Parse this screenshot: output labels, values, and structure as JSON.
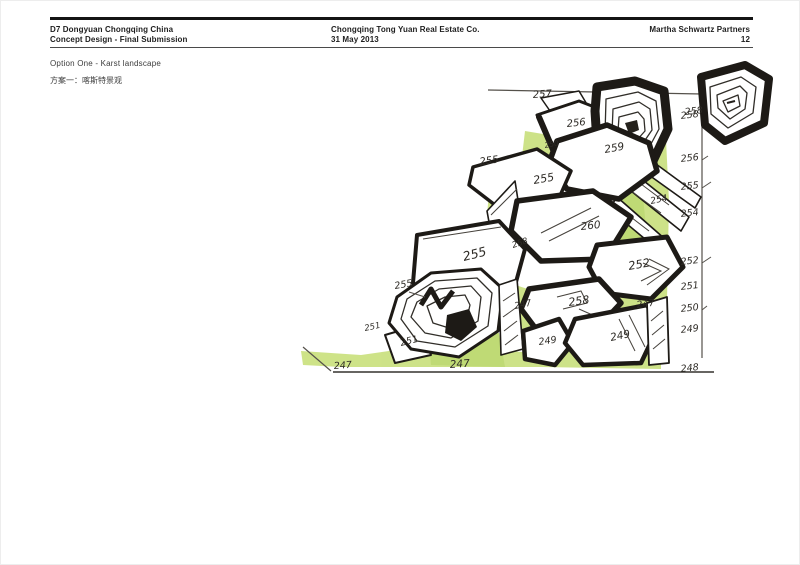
{
  "header": {
    "project_line1": "D7 Dongyuan Chongqing China",
    "project_line2": "Concept Design - Final Submission",
    "client_line1": "Chongqing Tong Yuan Real Estate Co.",
    "client_line2": "31 May 2013",
    "firm": "Martha Schwartz Partners",
    "page_number": "12"
  },
  "title": {
    "en": "Option One - Karst landscape",
    "cn": "方案一：喀斯特景观"
  },
  "sketch": {
    "colors": {
      "ink": "#1d1a16",
      "green": "#cbe182",
      "green_dark": "#bcd96e",
      "pencil": "#55514b"
    },
    "plan_labels": [
      {
        "text": "257",
        "x": 532,
        "y": 97,
        "rot": -4,
        "size": 10
      },
      {
        "text": "256",
        "x": 566,
        "y": 126,
        "rot": -6,
        "size": 10
      },
      {
        "text": "250",
        "x": 544,
        "y": 147,
        "rot": -10,
        "size": 7.5
      },
      {
        "text": "255",
        "x": 479,
        "y": 164,
        "rot": -8,
        "size": 10
      },
      {
        "text": "258",
        "x": 684,
        "y": 114,
        "rot": -6,
        "size": 9.5
      },
      {
        "text": "259",
        "x": 604,
        "y": 152,
        "rot": -10,
        "size": 10.5
      },
      {
        "text": "255",
        "x": 533,
        "y": 183,
        "rot": -10,
        "size": 11
      },
      {
        "text": "254",
        "x": 650,
        "y": 203,
        "rot": -12,
        "size": 9
      },
      {
        "text": "260",
        "x": 580,
        "y": 229,
        "rot": -6,
        "size": 10.5
      },
      {
        "text": "255",
        "x": 463,
        "y": 260,
        "rot": -14,
        "size": 12.5
      },
      {
        "text": "258",
        "x": 512,
        "y": 247,
        "rot": -18,
        "size": 8.5
      },
      {
        "text": "252",
        "x": 628,
        "y": 269,
        "rot": -10,
        "size": 11.5
      },
      {
        "text": "255",
        "x": 394,
        "y": 288,
        "rot": -10,
        "size": 9.5
      },
      {
        "text": "247",
        "x": 514,
        "y": 308,
        "rot": -12,
        "size": 9
      },
      {
        "text": "258",
        "x": 568,
        "y": 305,
        "rot": -8,
        "size": 11
      },
      {
        "text": "247",
        "x": 636,
        "y": 307,
        "rot": -8,
        "size": 9.5
      },
      {
        "text": "251",
        "x": 364,
        "y": 330,
        "rot": -12,
        "size": 8.5
      },
      {
        "text": "251",
        "x": 400,
        "y": 345,
        "rot": -14,
        "size": 9.5
      },
      {
        "text": "249",
        "x": 538,
        "y": 344,
        "rot": -8,
        "size": 9.5
      },
      {
        "text": "249",
        "x": 610,
        "y": 340,
        "rot": -12,
        "size": 10.5
      },
      {
        "text": "247",
        "x": 333,
        "y": 368,
        "rot": -4,
        "size": 9.5
      },
      {
        "text": "247",
        "x": 449,
        "y": 367,
        "rot": -4,
        "size": 10.5
      }
    ],
    "scale_x": 698,
    "scale_labels": [
      {
        "text": "258",
        "y": 116
      },
      {
        "text": "256",
        "y": 159
      },
      {
        "text": "255",
        "y": 187
      },
      {
        "text": "254",
        "y": 214
      },
      {
        "text": "252",
        "y": 262
      },
      {
        "text": "251",
        "y": 287
      },
      {
        "text": "250",
        "y": 309
      },
      {
        "text": "249",
        "y": 330
      },
      {
        "text": "248",
        "y": 369
      }
    ]
  }
}
